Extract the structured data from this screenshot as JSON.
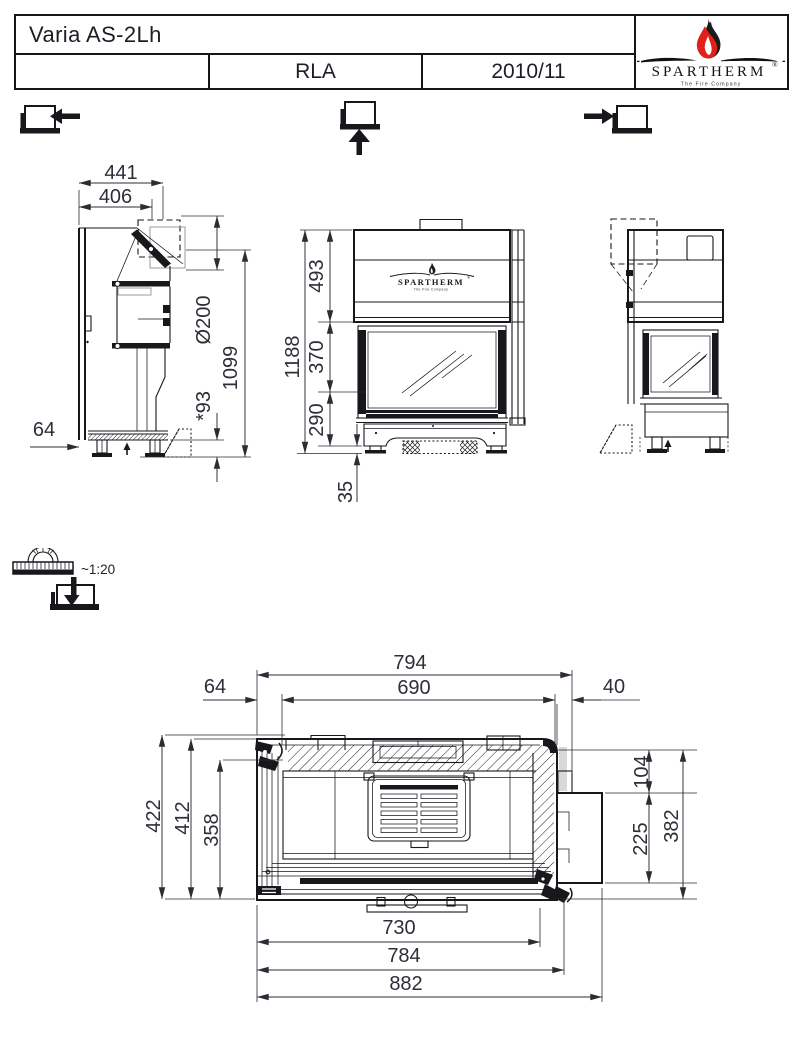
{
  "title_block": {
    "model_name": "Varia AS-2Lh",
    "left_cell": "",
    "air_system": "RLA",
    "model_year": "2010/11",
    "brand": {
      "name": "SPARTHERM",
      "registered_mark": "®",
      "tagline": "The Fire Company"
    }
  },
  "scale_indicator": {
    "ratio": "~1:20"
  },
  "elevation": {
    "side_left_view": {
      "dim_width_outer": "441",
      "dim_width_inner": "406",
      "dim_flue_diameter": "Ø200",
      "dim_height_flue_axis": "1099",
      "dim_rear_offset": "64",
      "dim_foot_adjust": "*93"
    },
    "front_view": {
      "brand_name": "SPARTHERM",
      "registered_mark": "®",
      "tagline": "The Fire Company",
      "dim_total_height": "1188",
      "dim_hood_height": "493",
      "dim_glass_height": "370",
      "dim_base_height": "290",
      "dim_floor_clearance": "35"
    }
  },
  "plan_view": {
    "dim_width_top": "794",
    "dim_opening_width": "690",
    "dim_offset_left": "64",
    "dim_offset_right": "40",
    "dim_depth_total": "422",
    "dim_depth_body": "412",
    "dim_depth_inner": "358",
    "dim_duct_offset": "104",
    "dim_duct_depth": "225",
    "dim_depth_right": "382",
    "dim_front_inner_width": "730",
    "dim_front_width": "784",
    "dim_max_width": "882"
  }
}
